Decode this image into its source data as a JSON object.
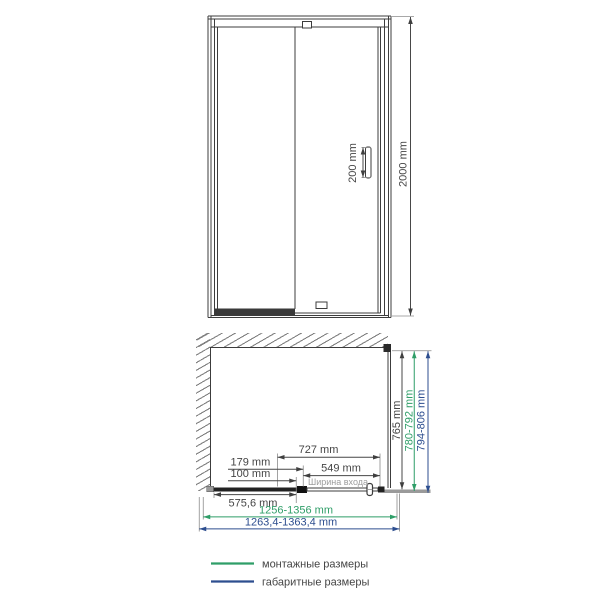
{
  "front_view": {
    "handle_dim": "200 mm",
    "height_dim": "2000 mm"
  },
  "plan_view": {
    "depth_dim": "765 mm",
    "depth_mounting_dim": "780-792 mm",
    "depth_overall_dim": "794-806 mm",
    "door_assembly_dim": "727 mm",
    "pivot_offset_dim": "179 mm",
    "pivot_inset_dim": "100 mm",
    "entrance_width_dim": "549 mm",
    "entrance_width_caption": "Ширина входа",
    "fixed_panel_dim": "575,6 mm",
    "width_mounting_dim": "1256-1356 mm",
    "width_overall_dim": "1263,4-1363,4 mm"
  },
  "legend": {
    "mounting": {
      "label": "монтажные размеры",
      "color": "#2f9e68"
    },
    "overall": {
      "label": "габаритные размеры",
      "color": "#2d4e8f"
    }
  },
  "colors": {
    "mounting_green": "#2f9e68",
    "overall_blue": "#2d4e8f",
    "line_dark": "#3f3f3f"
  }
}
